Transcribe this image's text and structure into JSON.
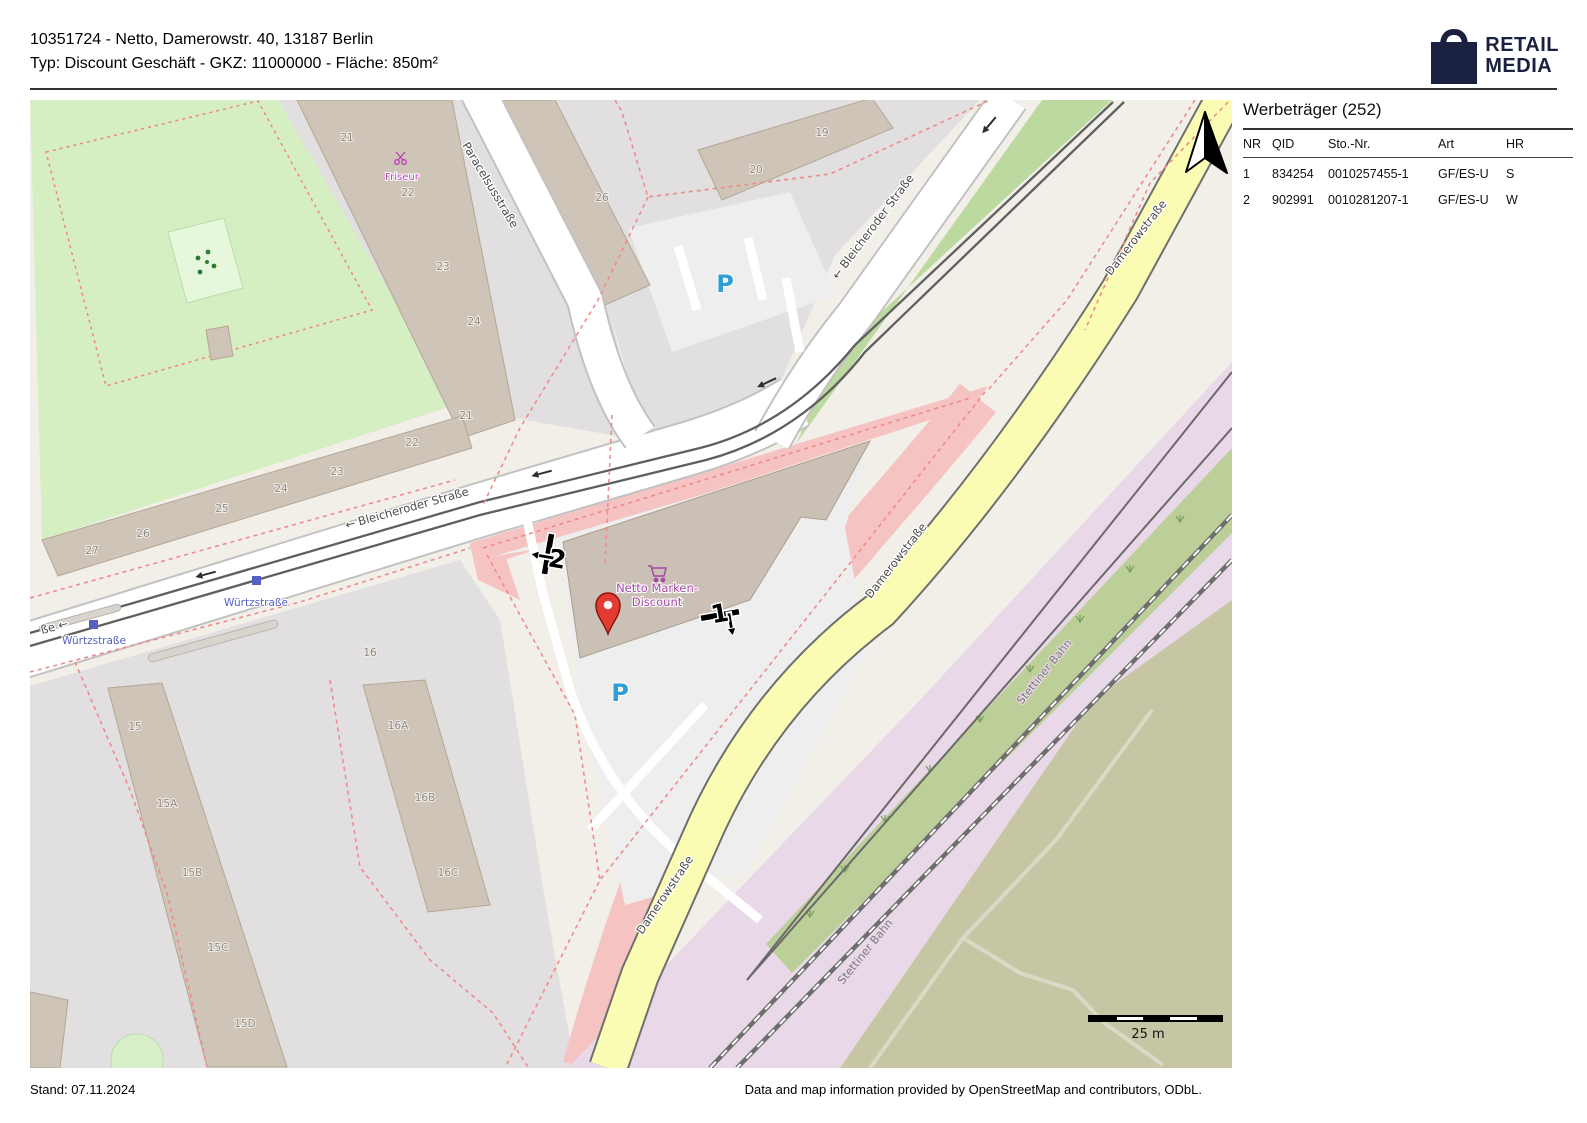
{
  "palette": {
    "park": "#d6efc2",
    "playground": "#e7f7dc",
    "pink": "#f6c3c3",
    "lilac": "#e9d8e7",
    "olive": "#c6c6a4",
    "roadYellow": "#fafcb4",
    "grayLand": "#e1dfdf",
    "base": "#f2efe9",
    "building": "#cfc4b8",
    "buildingEdge": "#b3a696",
    "nettoBuilding": "#cbc0b6",
    "dashedRed": "#ef8a8a",
    "markerRed": "#e23b32",
    "markerRedEdge": "#8c1410",
    "transitBlue": "#5560c4",
    "poiPurple": "#a646a6",
    "friseurMagenta": "#bb3dbb",
    "parkingBlue": "#2f9ed4",
    "logoNavy": "#1a2040",
    "greenWedge": "#bcd9a0",
    "scrubGreen": "#bccf98",
    "tram": "#5f5f5f"
  },
  "header": {
    "line1": "10351724 - Netto, Damerowstr. 40, 13187 Berlin",
    "line2": "Typ: Discount Geschäft - GKZ: 11000000 - Fläche: 850m²"
  },
  "logo": {
    "top": "RETAIL",
    "bottom": "MEDIA"
  },
  "panel": {
    "title": "Werbeträger (252)",
    "columns": [
      "NR",
      "QID",
      "Sto.-Nr.",
      "Art",
      "HR"
    ],
    "rows": [
      [
        "1",
        "834254",
        "0010257455-1",
        "GF/ES-U",
        "S"
      ],
      [
        "2",
        "902991",
        "0010281207-1",
        "GF/ES-U",
        "W"
      ]
    ]
  },
  "footer": {
    "left": "Stand: 07.11.2024",
    "right": "Data and map information provided by OpenStreetMap and contributors, ODbL."
  },
  "map": {
    "scale_label": "25 m",
    "streets": {
      "paracelsus": "Paracelsusstraße",
      "bleicheroder_w": "← Bleicheroder Straße",
      "bleicheroder_ne": "← Bleicheroder Straße",
      "damerow": "Damerowstraße",
      "stettiner": "Stettiner Bahn",
      "wurtz": "Würtzstraße",
      "wurtz_partial": "ße ←"
    },
    "house_numbers": [
      "21",
      "22",
      "23",
      "24",
      "26",
      "19",
      "20",
      "21",
      "22",
      "23",
      "24",
      "25",
      "26",
      "27",
      "16",
      "15",
      "15A",
      "15B",
      "15C",
      "15D",
      "16A",
      "16B",
      "16C"
    ],
    "poi": {
      "friseur": "Friseur",
      "netto1": "Netto Marken-",
      "netto2": "Discount",
      "parking": "P"
    },
    "billboards": {
      "b1": "1",
      "b2": "2"
    }
  }
}
